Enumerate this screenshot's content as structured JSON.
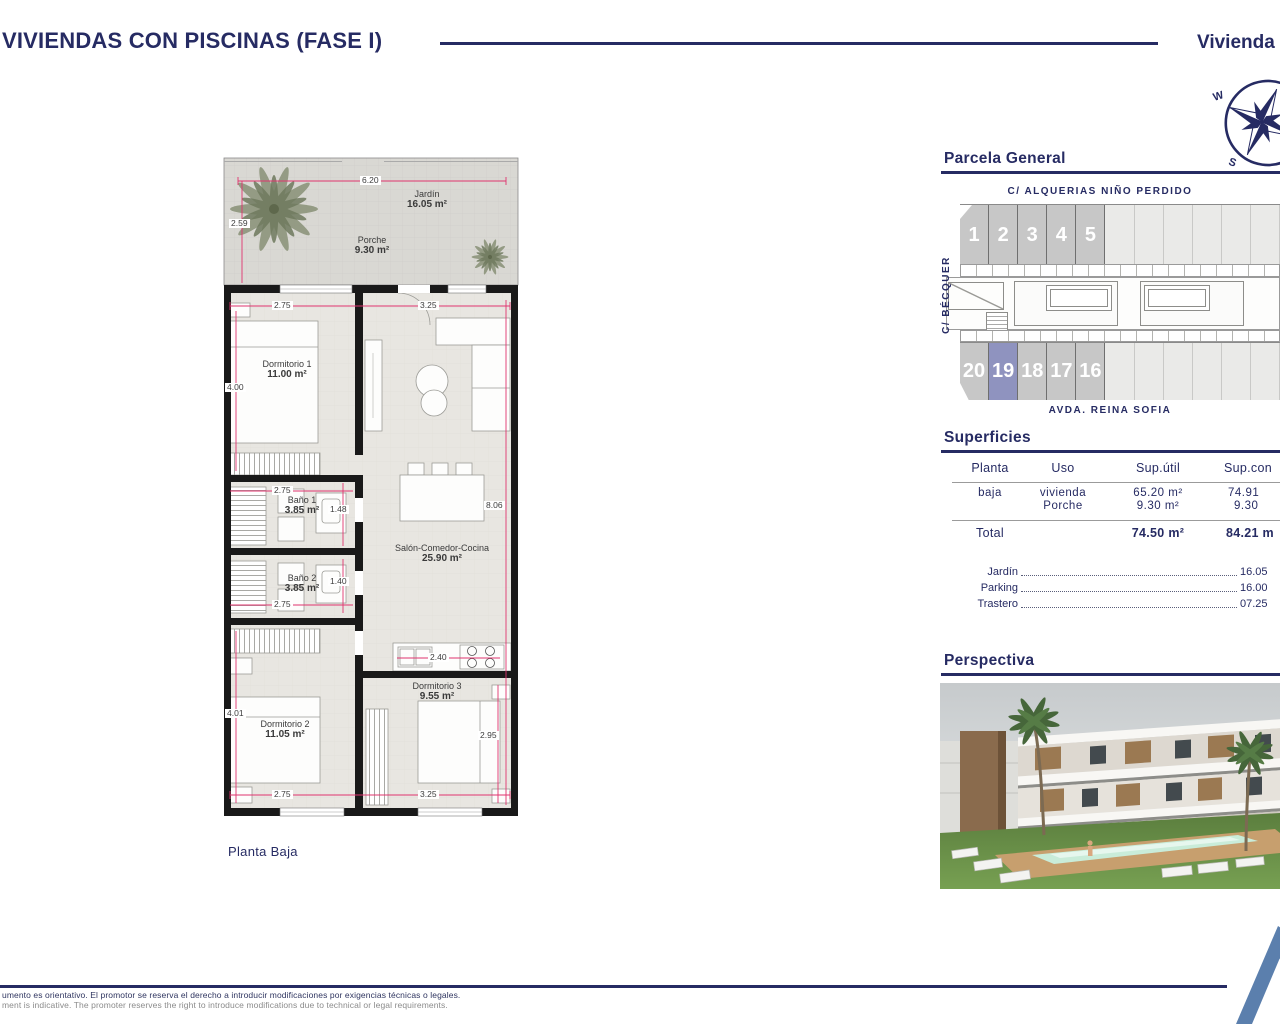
{
  "colors": {
    "navy": "#262b63",
    "dim_pink": "#e0346e",
    "highlight_unit": "#8f93bf",
    "unit_gray": "#c7c7c7"
  },
  "header": {
    "title": "VIVIENDAS CON PISCINAS (FASE I)",
    "right_title": "Vivienda"
  },
  "compass": {
    "w": "W",
    "s": "S"
  },
  "floorplan": {
    "label": "Planta Baja",
    "jardin": {
      "name": "Jardín",
      "area": "16.05 m²"
    },
    "porche": {
      "name": "Porche",
      "area": "9.30 m²"
    },
    "rooms": {
      "dorm1": {
        "name": "Dormitorio 1",
        "area": "11.00 m²"
      },
      "dorm2": {
        "name": "Dormitorio 2",
        "area": "11.05 m²"
      },
      "dorm3": {
        "name": "Dormitorio 3",
        "area": "9.55 m²"
      },
      "bano1": {
        "name": "Baño 1",
        "area": "3.85 m²"
      },
      "bano2": {
        "name": "Baño 2",
        "area": "3.85 m²"
      },
      "salon": {
        "name": "Salón-Comedor-Cocina",
        "area": "25.90 m²"
      }
    },
    "dims": {
      "terrace_w": "6.20",
      "terrace_h": "2.59",
      "dorm1_w": "2.75",
      "dorm1_h": "4.00",
      "salon_w": "3.25",
      "salon_h": "8.06",
      "bano1_w": "2.75",
      "bano1_h": "1.48",
      "bano2_h": "1.40",
      "bano2_w": "2.75",
      "dorm2_h": "4.01",
      "dorm2_w": "2.75",
      "dorm3_w": "3.25",
      "dorm3_h": "2.95",
      "kitchen_w": "2.40"
    }
  },
  "parcela": {
    "title": "Parcela General",
    "street_top": "C/ ALQUERIAS NIÑO PERDIDO",
    "street_left": "C/ BÉCQUER",
    "street_bottom": "AVDA. REINA SOFIA",
    "top_units": [
      "1",
      "2",
      "3",
      "4",
      "5"
    ],
    "bottom_units": [
      "20",
      "19",
      "18",
      "17",
      "16"
    ],
    "highlighted_unit": "19"
  },
  "superficies": {
    "title": "Superficies",
    "headers": [
      "Planta",
      "Uso",
      "Sup.útil",
      "Sup.con"
    ],
    "rows": [
      {
        "planta": "baja",
        "uso": "vivienda",
        "util": "65.20 m²",
        "cons": "74.91"
      },
      {
        "planta": "",
        "uso": "Porche",
        "util": "9.30 m²",
        "cons": "9.30"
      }
    ],
    "total": {
      "label": "Total",
      "util": "74.50 m²",
      "cons": "84.21 m"
    }
  },
  "extras": [
    {
      "label": "Jardín",
      "value": "16.05"
    },
    {
      "label": "Parking",
      "value": "16.00"
    },
    {
      "label": "Trastero",
      "value": "07.25"
    }
  ],
  "perspectiva": {
    "title": "Perspectiva"
  },
  "footer": {
    "line1": "umento es orientativo. El promotor se reserva el derecho a introducir modificaciones por exigencias técnicas o legales.",
    "line2": "ment is indicative. The promoter reserves the right to introduce modifications due to technical or legal requirements."
  }
}
